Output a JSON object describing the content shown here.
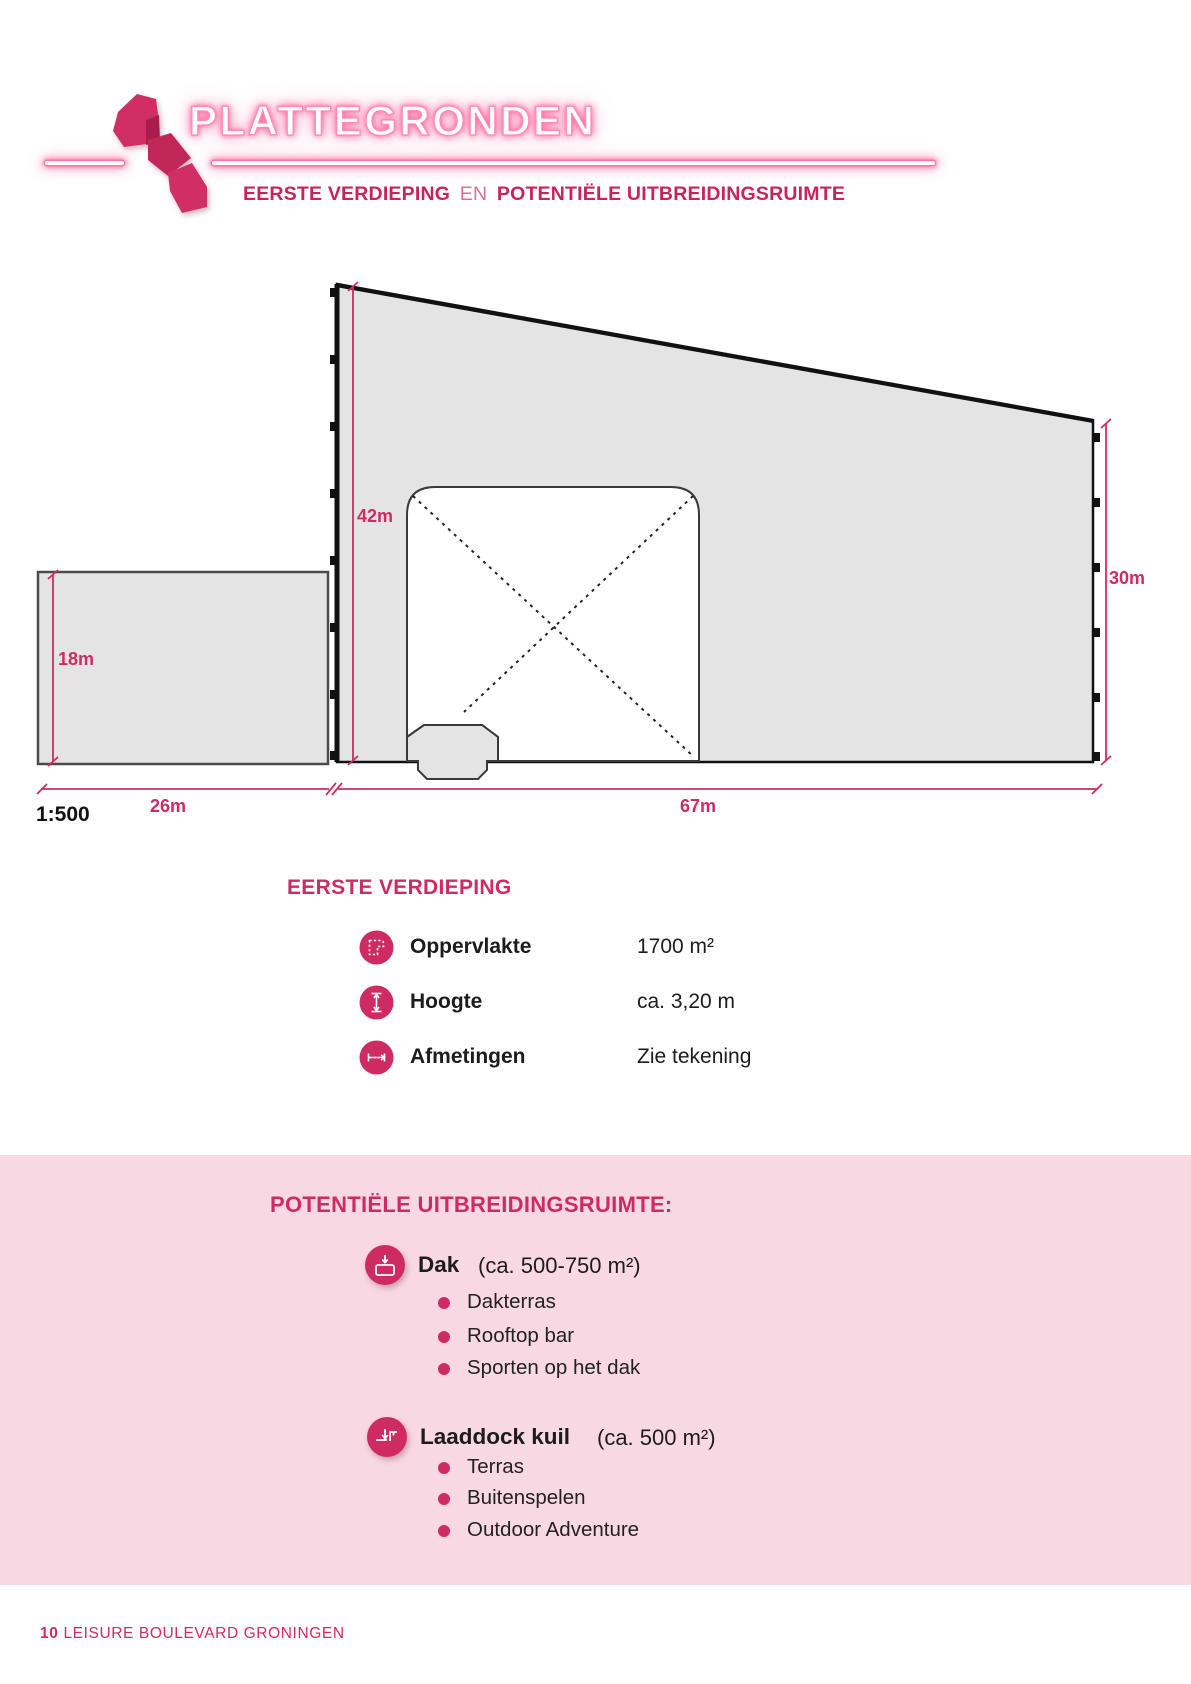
{
  "header": {
    "page_numeral": "1",
    "title": "PLATTEGRONDEN",
    "subtitle_part1": "EERSTE VERDIEPING",
    "subtitle_part2": "EN",
    "subtitle_part3": "POTENTIËLE UITBREIDINGSRUIMTE"
  },
  "diagram": {
    "scale_label": "1:500",
    "dimensions": {
      "main_height_left": "42m",
      "main_height_right": "30m",
      "annex_height": "18m",
      "annex_width": "26m",
      "main_width": "67m"
    }
  },
  "first_floor": {
    "heading": "EERSTE VERDIEPING",
    "rows": [
      {
        "icon": "area-icon",
        "label": "Oppervlakte",
        "value": "1700 m²"
      },
      {
        "icon": "height-icon",
        "label": "Hoogte",
        "value": "ca. 3,20 m"
      },
      {
        "icon": "dimensions-icon",
        "label": "Afmetingen",
        "value": "Zie tekening"
      }
    ]
  },
  "expansion": {
    "heading": "POTENTIËLE UITBREIDINGSRUIMTE:",
    "groups": [
      {
        "icon": "roof-icon",
        "title": "Dak",
        "subtitle": "(ca. 500-750 m²)",
        "bullets": [
          "Dakterras",
          "Rooftop bar",
          "Sporten op het dak"
        ]
      },
      {
        "icon": "loading-dock-icon",
        "title": "Laaddock kuil",
        "subtitle": "(ca. 500 m²)",
        "bullets": [
          "Terras",
          "Buitenspelen",
          "Outdoor Adventure"
        ]
      }
    ]
  },
  "footer": {
    "page_number": "10",
    "text": "LEISURE BOULEVARD GRONINGEN"
  },
  "colors": {
    "primary_pink": "#cf2b63",
    "panel_background": "#f8d8e3",
    "shape_fill": "#e4e4e5",
    "outline": "#111111",
    "neon_glow": "#ff5c97"
  }
}
